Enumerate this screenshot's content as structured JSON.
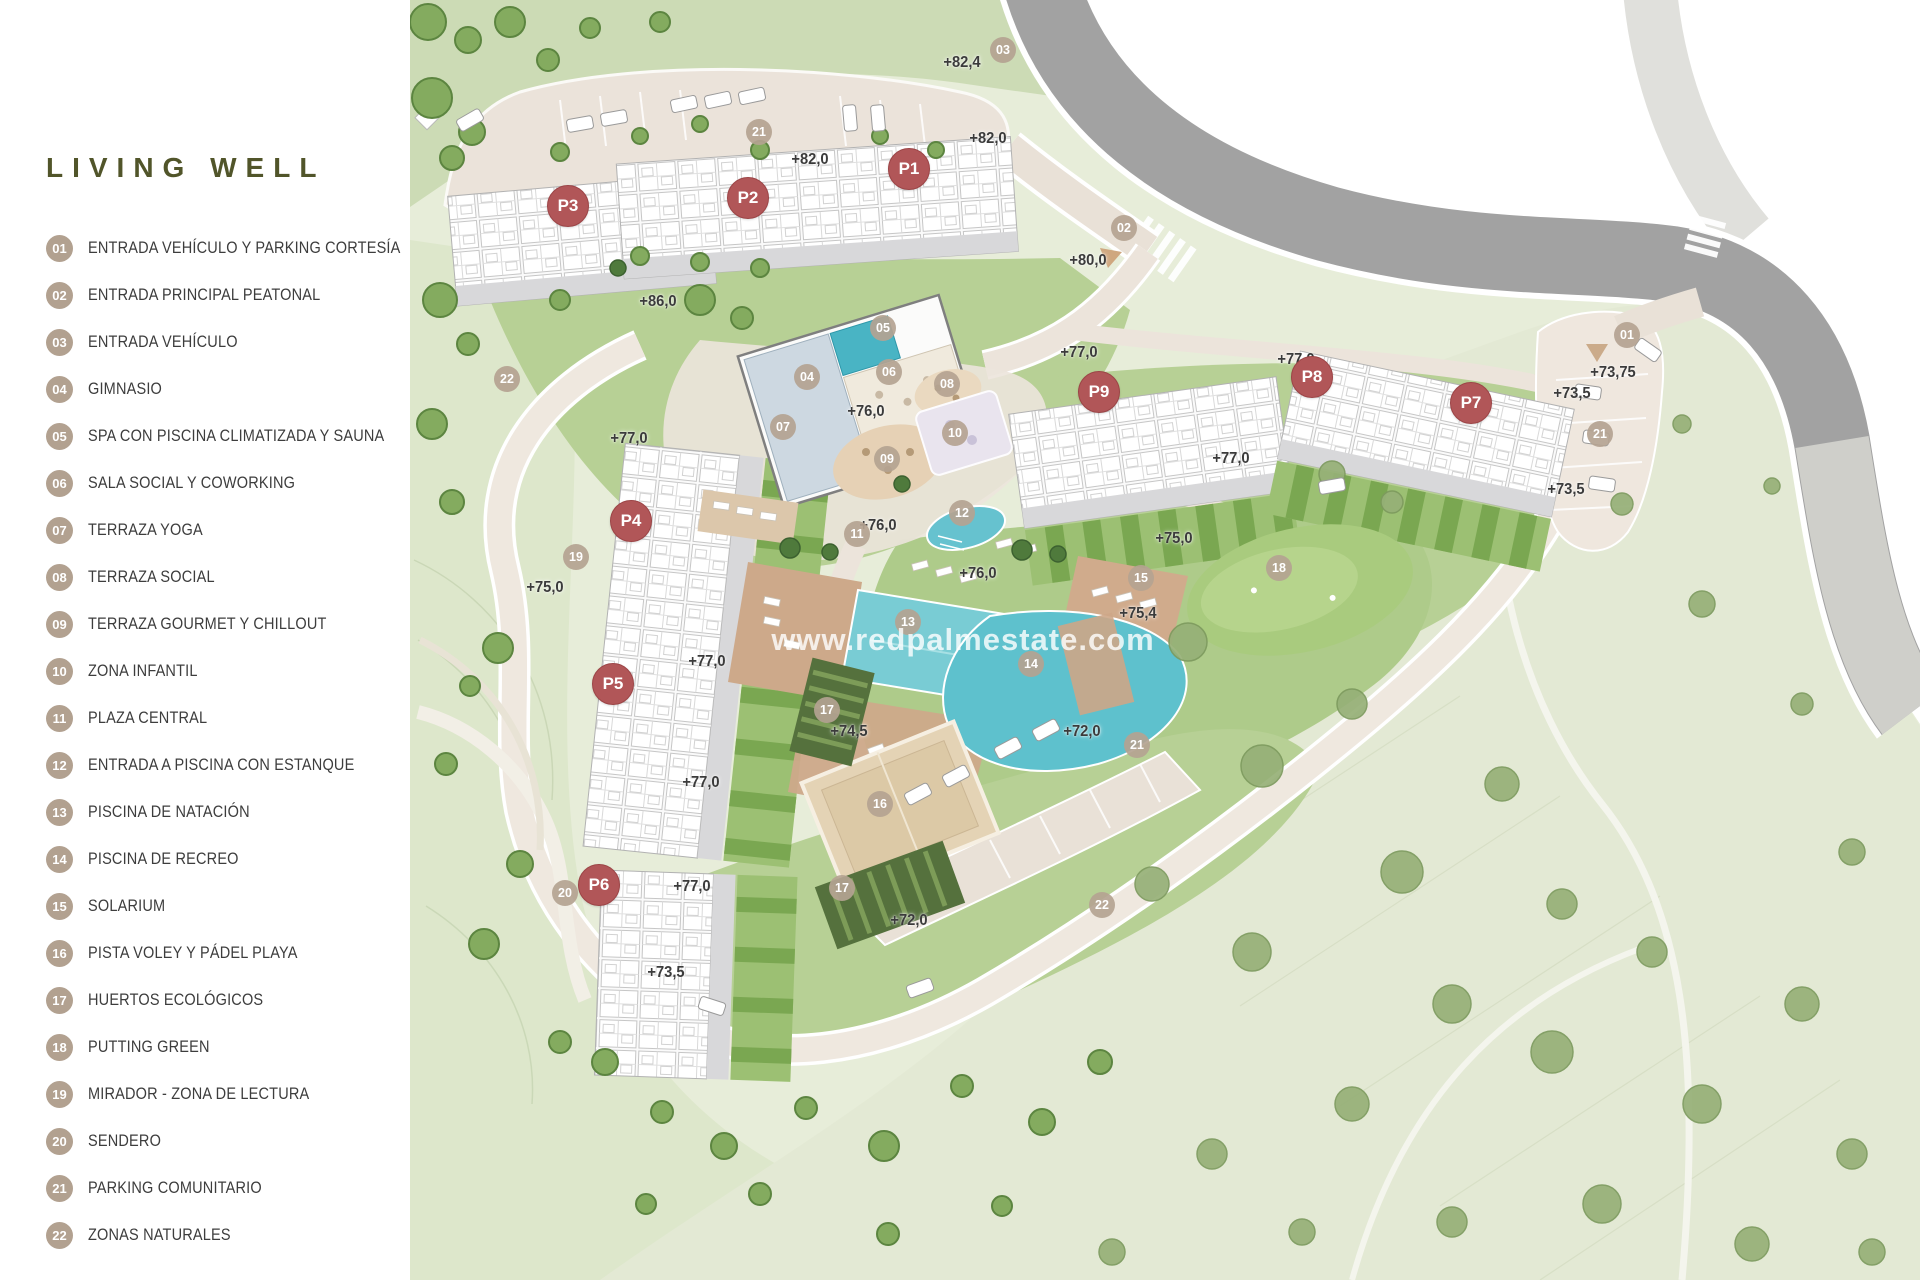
{
  "title": "LIVING WELL",
  "colors": {
    "brand_olive": "#51552a",
    "marker_red": "#b15658",
    "badge_tan": "#b2a190",
    "pool_teal": "#5ec1cd",
    "road_grey": "#a2a2a2"
  },
  "legend": {
    "items": [
      {
        "num": "01",
        "label": "ENTRADA VEHÍCULO Y PARKING CORTESÍA"
      },
      {
        "num": "02",
        "label": "ENTRADA PRINCIPAL PEATONAL"
      },
      {
        "num": "03",
        "label": "ENTRADA VEHÍCULO"
      },
      {
        "num": "04",
        "label": "GIMNASIO"
      },
      {
        "num": "05",
        "label": "SPA CON PISCINA CLIMATIZADA Y SAUNA"
      },
      {
        "num": "06",
        "label": "SALA SOCIAL Y COWORKING"
      },
      {
        "num": "07",
        "label": "TERRAZA YOGA"
      },
      {
        "num": "08",
        "label": "TERRAZA SOCIAL"
      },
      {
        "num": "09",
        "label": "TERRAZA GOURMET Y CHILLOUT"
      },
      {
        "num": "10",
        "label": "ZONA INFANTIL"
      },
      {
        "num": "11",
        "label": "PLAZA CENTRAL"
      },
      {
        "num": "12",
        "label": "ENTRADA A PISCINA CON ESTANQUE"
      },
      {
        "num": "13",
        "label": "PISCINA DE NATACIÓN"
      },
      {
        "num": "14",
        "label": "PISCINA DE RECREO"
      },
      {
        "num": "15",
        "label": "SOLARIUM"
      },
      {
        "num": "16",
        "label": "PISTA VOLEY Y PÁDEL PLAYA"
      },
      {
        "num": "17",
        "label": "HUERTOS ECOLÓGICOS"
      },
      {
        "num": "18",
        "label": "PUTTING GREEN"
      },
      {
        "num": "19",
        "label": "MIRADOR - ZONA DE LECTURA"
      },
      {
        "num": "20",
        "label": "SENDERO"
      },
      {
        "num": "21",
        "label": "PARKING COMUNITARIO"
      },
      {
        "num": "22",
        "label": "ZONAS NATURALES"
      }
    ]
  },
  "map": {
    "watermark": "www.redpalmestate.com",
    "building_markers": [
      {
        "label": "P1",
        "x": 909,
        "y": 169
      },
      {
        "label": "P2",
        "x": 748,
        "y": 198
      },
      {
        "label": "P3",
        "x": 568,
        "y": 206
      },
      {
        "label": "P4",
        "x": 631,
        "y": 521
      },
      {
        "label": "P5",
        "x": 613,
        "y": 684
      },
      {
        "label": "P6",
        "x": 599,
        "y": 885
      },
      {
        "label": "P7",
        "x": 1471,
        "y": 403
      },
      {
        "label": "P8",
        "x": 1312,
        "y": 377
      },
      {
        "label": "P9",
        "x": 1099,
        "y": 392
      }
    ],
    "point_markers": [
      {
        "label": "01",
        "x": 1627,
        "y": 335
      },
      {
        "label": "02",
        "x": 1124,
        "y": 228
      },
      {
        "label": "03",
        "x": 1003,
        "y": 50
      },
      {
        "label": "04",
        "x": 807,
        "y": 377
      },
      {
        "label": "05",
        "x": 883,
        "y": 328
      },
      {
        "label": "06",
        "x": 889,
        "y": 372
      },
      {
        "label": "07",
        "x": 783,
        "y": 427
      },
      {
        "label": "08",
        "x": 947,
        "y": 384
      },
      {
        "label": "09",
        "x": 887,
        "y": 459
      },
      {
        "label": "10",
        "x": 955,
        "y": 433
      },
      {
        "label": "11",
        "x": 857,
        "y": 534
      },
      {
        "label": "12",
        "x": 962,
        "y": 513
      },
      {
        "label": "13",
        "x": 908,
        "y": 622
      },
      {
        "label": "14",
        "x": 1031,
        "y": 664
      },
      {
        "label": "15",
        "x": 1141,
        "y": 578
      },
      {
        "label": "16",
        "x": 880,
        "y": 804
      },
      {
        "label": "17",
        "x": 827,
        "y": 710
      },
      {
        "label": "17",
        "x": 842,
        "y": 888
      },
      {
        "label": "18",
        "x": 1279,
        "y": 568
      },
      {
        "label": "19",
        "x": 576,
        "y": 557
      },
      {
        "label": "20",
        "x": 565,
        "y": 893
      },
      {
        "label": "21",
        "x": 759,
        "y": 132
      },
      {
        "label": "21",
        "x": 1600,
        "y": 434
      },
      {
        "label": "21",
        "x": 1137,
        "y": 745
      },
      {
        "label": "22",
        "x": 507,
        "y": 379
      },
      {
        "label": "22",
        "x": 1102,
        "y": 905
      }
    ],
    "elevation_labels": [
      {
        "text": "+82,4",
        "x": 962,
        "y": 63
      },
      {
        "text": "+82,0",
        "x": 988,
        "y": 139
      },
      {
        "text": "+82,0",
        "x": 810,
        "y": 160
      },
      {
        "text": "+86,0",
        "x": 658,
        "y": 302
      },
      {
        "text": "+80,0",
        "x": 1088,
        "y": 261
      },
      {
        "text": "+77,0",
        "x": 1079,
        "y": 353
      },
      {
        "text": "+77,0",
        "x": 1296,
        "y": 360
      },
      {
        "text": "+73,75",
        "x": 1613,
        "y": 373
      },
      {
        "text": "+73,5",
        "x": 1572,
        "y": 394
      },
      {
        "text": "+76,0",
        "x": 866,
        "y": 412
      },
      {
        "text": "+77,0",
        "x": 629,
        "y": 439
      },
      {
        "text": "+77,0",
        "x": 1231,
        "y": 459
      },
      {
        "text": "+73,5",
        "x": 1566,
        "y": 490
      },
      {
        "text": "+76,0",
        "x": 878,
        "y": 526
      },
      {
        "text": "+75,0",
        "x": 1174,
        "y": 539
      },
      {
        "text": "+76,0",
        "x": 978,
        "y": 574
      },
      {
        "text": "+75,0",
        "x": 545,
        "y": 588
      },
      {
        "text": "+75,4",
        "x": 1138,
        "y": 614
      },
      {
        "text": "+77,0",
        "x": 707,
        "y": 662
      },
      {
        "text": "+74,5",
        "x": 849,
        "y": 732
      },
      {
        "text": "+72,0",
        "x": 1082,
        "y": 732
      },
      {
        "text": "+77,0",
        "x": 701,
        "y": 783
      },
      {
        "text": "+77,0",
        "x": 692,
        "y": 887
      },
      {
        "text": "+72,0",
        "x": 909,
        "y": 921
      },
      {
        "text": "+73,5",
        "x": 666,
        "y": 973
      }
    ]
  }
}
